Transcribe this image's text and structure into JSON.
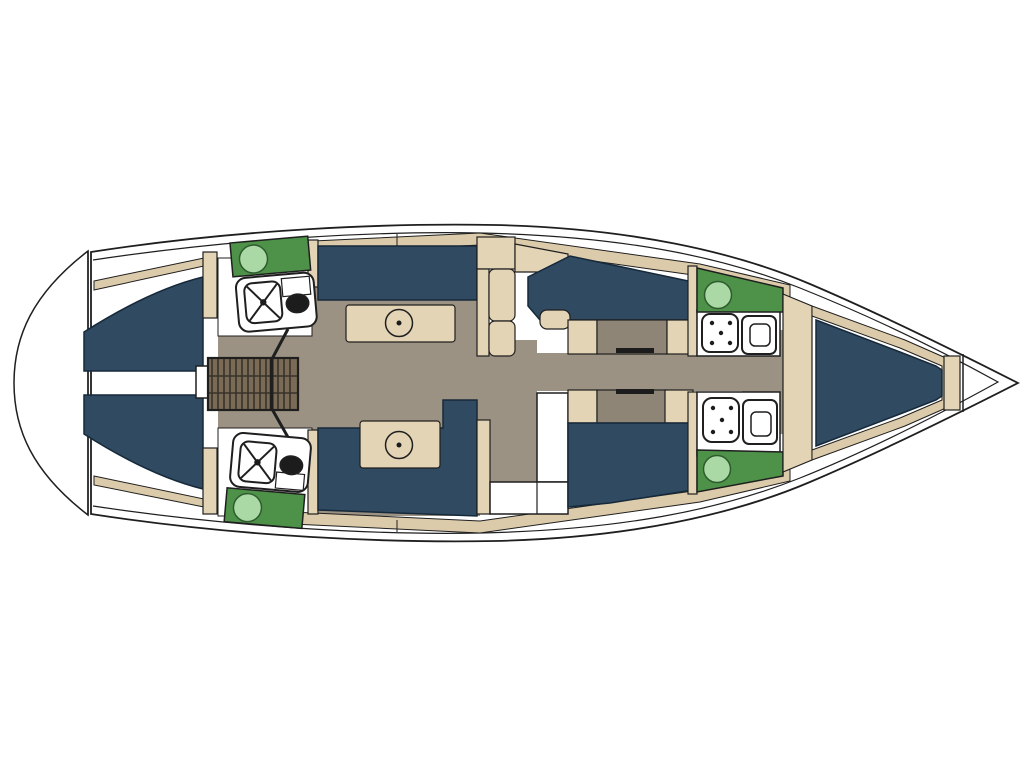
{
  "scene": {
    "type": "sailing-yacht-interior-deck-plan",
    "orientation": "bow-right",
    "areas": [
      "stern-swim-platform",
      "aft-cabin-top",
      "aft-cabin-bottom",
      "companionway-stairs",
      "galley-top",
      "galley-bottom",
      "saloon-bench-top",
      "saloon-table-top",
      "saloon-bench-bottom",
      "saloon-table-bottom",
      "storage-cabinet",
      "day-head-compartment",
      "mid-cabin-top",
      "mid-cabin-bottom",
      "head-top",
      "head-bottom",
      "owners-cabin-bow",
      "anchor-locker"
    ],
    "fixtures": [
      "round-sink",
      "stove-burner",
      "galley-basin",
      "shower-tray",
      "toilet",
      "pedestal-table",
      "berth-cushion",
      "stair-treads"
    ]
  },
  "colors": {
    "background": "#FFFFFF",
    "hull_line": "#1F1F1F",
    "upholstery_navy": "#2F4A61",
    "wood_tan": "#E3D4B6",
    "deck_tan": "#DCCBAA",
    "floor_taupe": "#9C9283",
    "floor_dark": "#8F8576",
    "counter_green": "#4E9148",
    "sink_green": "#ABD9A6",
    "stair_brown": "#7A6B56",
    "stair_stripe": "#39322A",
    "fixture_dark": "#1C1C1C"
  }
}
